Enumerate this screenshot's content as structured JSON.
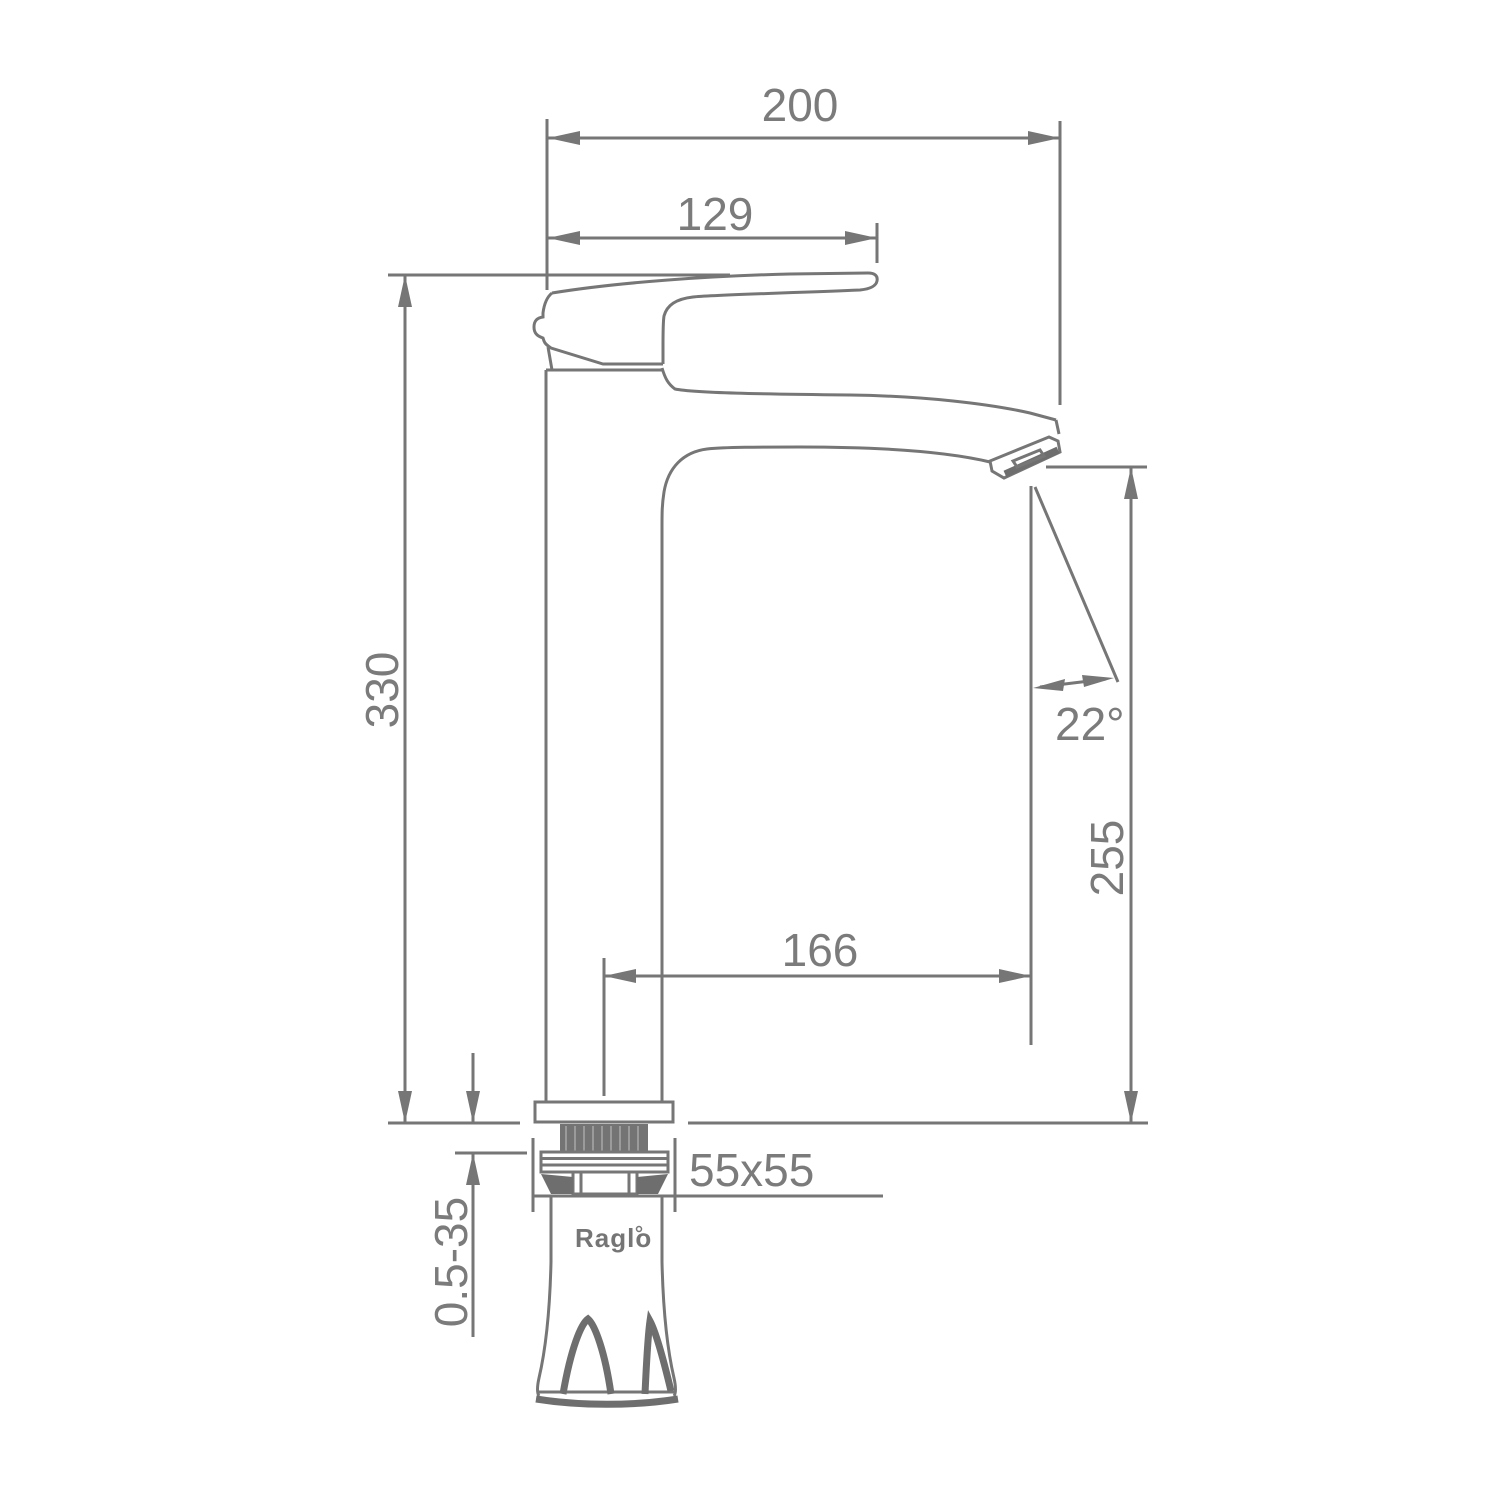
{
  "drawing": {
    "type": "technical-dimension-drawing",
    "subject": "single-lever tall basin faucet, side elevation",
    "brand": "Raglo",
    "labels": {
      "overall_width": "200",
      "handle_length": "129",
      "total_height": "330",
      "spout_angle": "22°",
      "spout_outlet_height": "255",
      "spout_reach": "166",
      "base_size": "55x55",
      "mounting_thickness_range": "0.5-35"
    },
    "colors": {
      "line": "#767676",
      "dark_fill": "#6e6e6e",
      "text": "#7b7b7b",
      "background": "#ffffff"
    }
  }
}
